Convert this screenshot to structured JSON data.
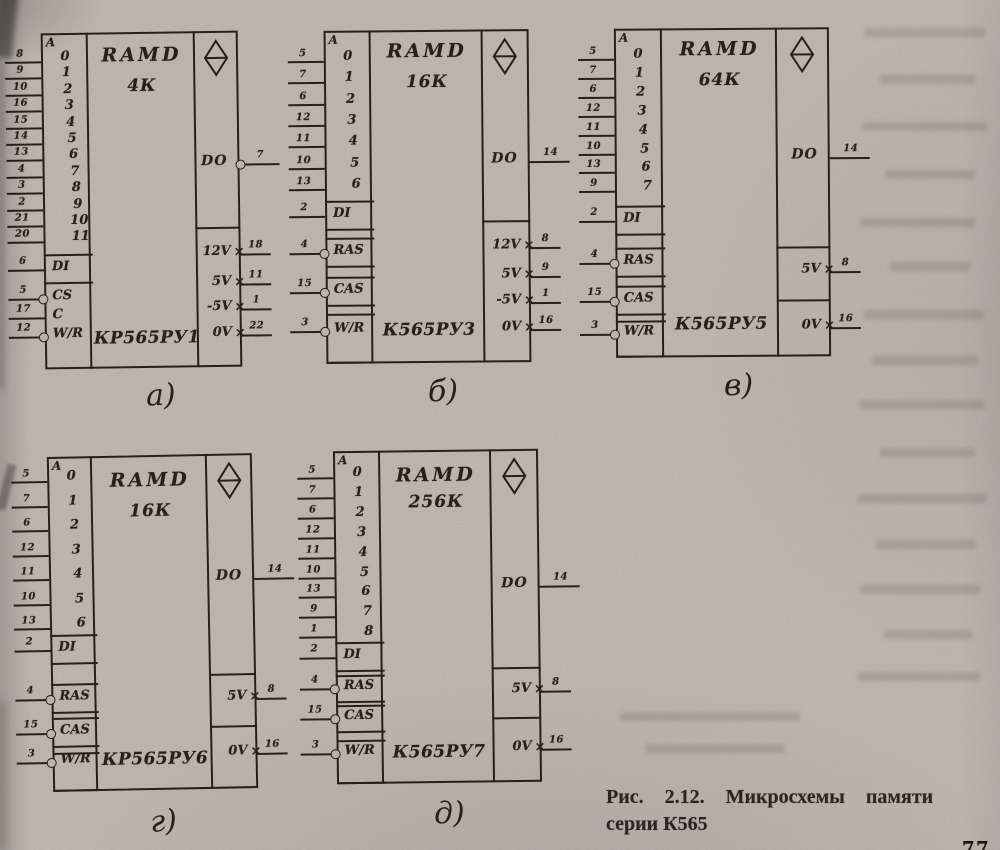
{
  "figure": {
    "caption_line1": "Рис. 2.12. Микросхемы памяти",
    "caption_line2": "серии К565",
    "page_mark": "77"
  },
  "colors": {
    "paper": "#bdb9b1",
    "ink": "#27211a"
  },
  "chips": [
    {
      "id": "a",
      "sub_label": "а)",
      "type_label": "RAMD",
      "capacity": "4К",
      "part_number": "КР565РУ1",
      "addr_header": "A",
      "memory_symbol": "ram-diamond-icon",
      "address_pins": [
        {
          "pin": "8",
          "bit": "0"
        },
        {
          "pin": "9",
          "bit": "1"
        },
        {
          "pin": "10",
          "bit": "2"
        },
        {
          "pin": "16",
          "bit": "3"
        },
        {
          "pin": "15",
          "bit": "4"
        },
        {
          "pin": "14",
          "bit": "5"
        },
        {
          "pin": "13",
          "bit": "6"
        },
        {
          "pin": "4",
          "bit": "7"
        },
        {
          "pin": "3",
          "bit": "8"
        },
        {
          "pin": "2",
          "bit": "9"
        },
        {
          "pin": "21",
          "bit": "10"
        },
        {
          "pin": "20",
          "bit": "11"
        }
      ],
      "controls": [
        {
          "label": "DI",
          "pin": "6",
          "bubble": false
        },
        {
          "label": "CS",
          "pin": "5",
          "bubble": true
        },
        {
          "label": "C",
          "pin": "17",
          "bubble": false
        },
        {
          "label": "W/R",
          "pin": "12",
          "bubble": true
        }
      ],
      "output": {
        "label": "DO",
        "pin": "7",
        "bubble": true
      },
      "power_pins": [
        {
          "label": "12V",
          "pin": "18"
        },
        {
          "label": "5V",
          "pin": "11"
        },
        {
          "label": "-5V",
          "pin": "1"
        },
        {
          "label": "0V",
          "pin": "22"
        }
      ]
    },
    {
      "id": "b",
      "sub_label": "б)",
      "type_label": "RAMD",
      "capacity": "16К",
      "part_number": "К565РУ3",
      "addr_header": "A",
      "memory_symbol": "ram-diamond-icon",
      "address_pins": [
        {
          "pin": "5",
          "bit": "0"
        },
        {
          "pin": "7",
          "bit": "1"
        },
        {
          "pin": "6",
          "bit": "2"
        },
        {
          "pin": "12",
          "bit": "3"
        },
        {
          "pin": "11",
          "bit": "4"
        },
        {
          "pin": "10",
          "bit": "5"
        },
        {
          "pin": "13",
          "bit": "6"
        }
      ],
      "controls": [
        {
          "label": "DI",
          "pin": "2",
          "bubble": false
        },
        {
          "label": "RAS",
          "pin": "4",
          "bubble": true
        },
        {
          "label": "CAS",
          "pin": "15",
          "bubble": true
        },
        {
          "label": "W/R",
          "pin": "3",
          "bubble": true
        }
      ],
      "output": {
        "label": "DO",
        "pin": "14",
        "bubble": false
      },
      "power_pins": [
        {
          "label": "12V",
          "pin": "8"
        },
        {
          "label": "5V",
          "pin": "9"
        },
        {
          "label": "-5V",
          "pin": "1"
        },
        {
          "label": "0V",
          "pin": "16"
        }
      ]
    },
    {
      "id": "v",
      "sub_label": "в)",
      "type_label": "RAMD",
      "capacity": "64К",
      "part_number": "К565РУ5",
      "addr_header": "A",
      "memory_symbol": "ram-diamond-icon",
      "address_pins": [
        {
          "pin": "5",
          "bit": "0"
        },
        {
          "pin": "7",
          "bit": "1"
        },
        {
          "pin": "6",
          "bit": "2"
        },
        {
          "pin": "12",
          "bit": "3"
        },
        {
          "pin": "11",
          "bit": "4"
        },
        {
          "pin": "10",
          "bit": "5"
        },
        {
          "pin": "13",
          "bit": "6"
        },
        {
          "pin": "9",
          "bit": "7"
        }
      ],
      "controls": [
        {
          "label": "DI",
          "pin": "2",
          "bubble": false
        },
        {
          "label": "RAS",
          "pin": "4",
          "bubble": true
        },
        {
          "label": "CAS",
          "pin": "15",
          "bubble": true
        },
        {
          "label": "W/R",
          "pin": "3",
          "bubble": true
        }
      ],
      "output": {
        "label": "DO",
        "pin": "14",
        "bubble": false
      },
      "power_pins": [
        {
          "label": "5V",
          "pin": "8"
        },
        {
          "label": "0V",
          "pin": "16"
        }
      ]
    },
    {
      "id": "g",
      "sub_label": "г)",
      "type_label": "RAMD",
      "capacity": "16К",
      "part_number": "КР565РУ6",
      "addr_header": "A",
      "memory_symbol": "ram-diamond-icon",
      "address_pins": [
        {
          "pin": "5",
          "bit": "0"
        },
        {
          "pin": "7",
          "bit": "1"
        },
        {
          "pin": "6",
          "bit": "2"
        },
        {
          "pin": "12",
          "bit": "3"
        },
        {
          "pin": "11",
          "bit": "4"
        },
        {
          "pin": "10",
          "bit": "5"
        },
        {
          "pin": "13",
          "bit": "6"
        }
      ],
      "controls": [
        {
          "label": "DI",
          "pin": "2",
          "bubble": false
        },
        {
          "label": "RAS",
          "pin": "4",
          "bubble": true
        },
        {
          "label": "CAS",
          "pin": "15",
          "bubble": true
        },
        {
          "label": "W/R",
          "pin": "3",
          "bubble": true
        }
      ],
      "output": {
        "label": "DO",
        "pin": "14",
        "bubble": false
      },
      "power_pins": [
        {
          "label": "5V",
          "pin": "8"
        },
        {
          "label": "0V",
          "pin": "16"
        }
      ]
    },
    {
      "id": "d",
      "sub_label": "д)",
      "type_label": "RAMD",
      "capacity": "256К",
      "part_number": "К565РУ7",
      "addr_header": "A",
      "memory_symbol": "ram-diamond-icon",
      "address_pins": [
        {
          "pin": "5",
          "bit": "0"
        },
        {
          "pin": "7",
          "bit": "1"
        },
        {
          "pin": "6",
          "bit": "2"
        },
        {
          "pin": "12",
          "bit": "3"
        },
        {
          "pin": "11",
          "bit": "4"
        },
        {
          "pin": "10",
          "bit": "5"
        },
        {
          "pin": "13",
          "bit": "6"
        },
        {
          "pin": "9",
          "bit": "7"
        },
        {
          "pin": "1",
          "bit": "8"
        }
      ],
      "controls": [
        {
          "label": "DI",
          "pin": "2",
          "bubble": false
        },
        {
          "label": "RAS",
          "pin": "4",
          "bubble": true
        },
        {
          "label": "CAS",
          "pin": "15",
          "bubble": true
        },
        {
          "label": "W/R",
          "pin": "3",
          "bubble": true
        }
      ],
      "output": {
        "label": "DO",
        "pin": "14",
        "bubble": false
      },
      "power_pins": [
        {
          "label": "5V",
          "pin": "8"
        },
        {
          "label": "0V",
          "pin": "16"
        }
      ]
    }
  ]
}
